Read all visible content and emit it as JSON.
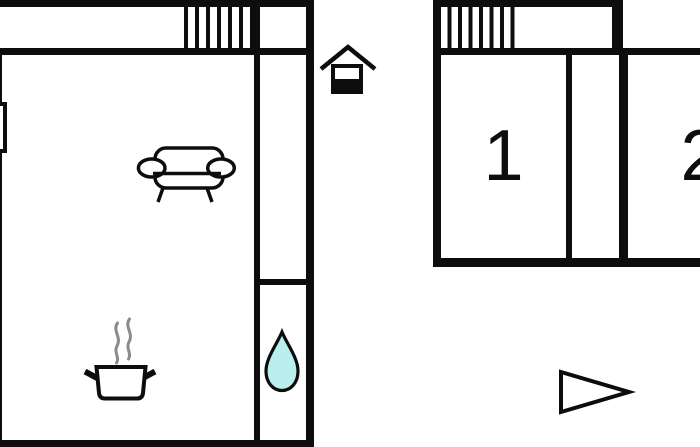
{
  "floorplan": {
    "rooms": {
      "room1": {
        "label": "1"
      },
      "room2": {
        "label": "2"
      }
    },
    "icons": {
      "floor_indicator": "house-ground-floor-icon",
      "stairs_left": "stairs-icon",
      "stairs_right": "stairs-icon",
      "sofa": "sofa-icon",
      "cooking_pot": "cooking-pot-steam-icon",
      "water_drop": "water-drop-icon",
      "direction_arrow": "triangle-right-icon",
      "window_opening": "window-opening-icon"
    },
    "colors": {
      "wall": "#0d0d0d",
      "background": "#ffffff",
      "water_drop_fill": "#b9f0ee",
      "steam": "#8a8a8a"
    }
  }
}
